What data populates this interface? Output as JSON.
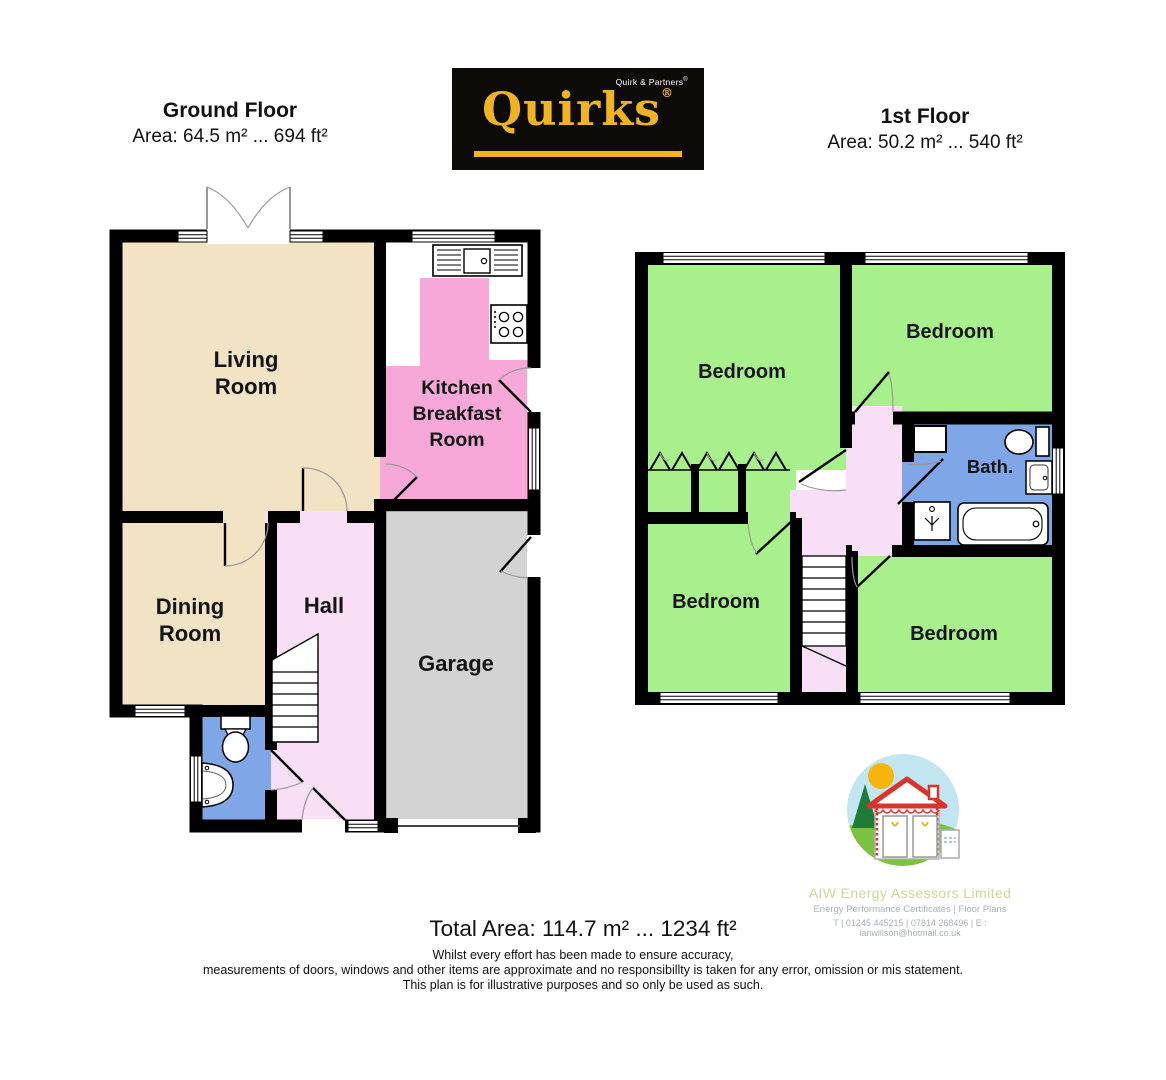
{
  "header": {
    "ground_title": "Ground Floor",
    "ground_area": "Area: 64.5 m² ... 694 ft²",
    "first_title": "1st Floor",
    "first_area": "Area: 50.2 m² ... 540 ft²"
  },
  "logo": {
    "brand": "Quirks",
    "partners": "Quirk & Partners",
    "reg": "®"
  },
  "ground_rooms": {
    "living1": "Living",
    "living2": "Room",
    "kitchen1": "Kitchen",
    "kitchen2": "Breakfast",
    "kitchen3": "Room",
    "dining1": "Dining",
    "dining2": "Room",
    "hall": "Hall",
    "garage": "Garage"
  },
  "first_rooms": {
    "bedroom_tl": "Bedroom",
    "bedroom_tr": "Bedroom",
    "bedroom_bl": "Bedroom",
    "bedroom_br": "Bedroom",
    "bath": "Bath."
  },
  "aiw": {
    "name": "AIW Energy Assessors Limited",
    "services": "Energy Performance Certificates | Floor Plans",
    "contact": "T | 01245 445215 | 07814 268496 | E : ianwillson@hotmail.co.uk"
  },
  "footer": {
    "total_area": "Total Area: 114.7 m² ... 1234 ft²",
    "disclaimer1": "Whilst every effort has been made to ensure accuracy,",
    "disclaimer2": "measurements of doors, windows and other items are approximate and no responsibillty is taken for any error, omission or mis statement.",
    "disclaimer3": "This plan is for illustrative purposes and so only be used as such."
  },
  "colors": {
    "room_tan": "#F1E3C3",
    "room_pink": "#F7A7D8",
    "room_lightpink": "#F8DFF6",
    "room_grey": "#D3D3D3",
    "room_blue": "#7FA7E8",
    "room_green": "#A8F08C",
    "wall_black": "#000000",
    "quirks_yellow": "#EFB41F",
    "aiw_green_text": "#C9D89B",
    "aiw_grey_text": "#A8B2B8"
  }
}
